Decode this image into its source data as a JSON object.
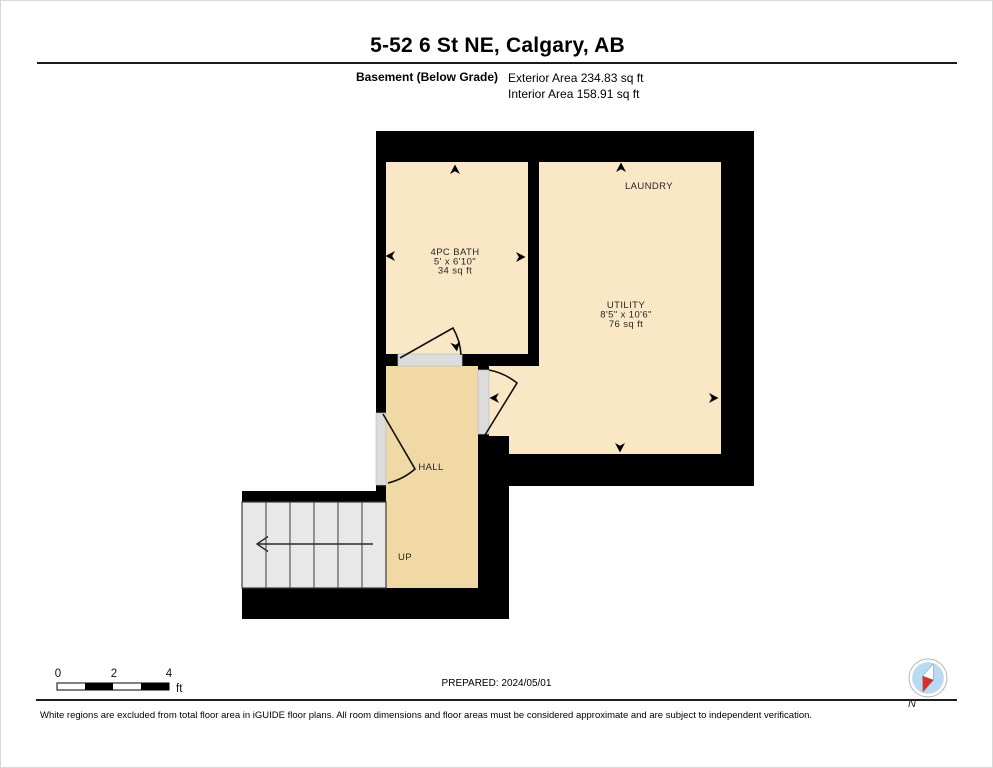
{
  "header": {
    "title": "5-52 6 St NE, Calgary, AB",
    "floor_label": "Basement (Below Grade)",
    "exterior_area": "Exterior Area 234.83 sq ft",
    "interior_area": "Interior Area 158.91 sq ft"
  },
  "floorplan": {
    "rooms": {
      "bath": {
        "name": "4PC BATH",
        "dims": "5' x 6'10\"",
        "area": "34 sq ft"
      },
      "laundry": {
        "name": "LAUNDRY"
      },
      "utility": {
        "name": "UTILITY",
        "dims": "8'5\" x 10'6\"",
        "area": "76 sq ft"
      },
      "hall": {
        "name": "HALL"
      }
    },
    "stairs": {
      "direction_label": "UP"
    },
    "colors": {
      "wall": "#000000",
      "room_fill": "#FAE7C5",
      "hall_fill": "#F0D9A4",
      "door_opening": "#DCDCDC",
      "stairs_fill": "#E8E8E8"
    }
  },
  "scale_bar": {
    "tick0": "0",
    "tick1": "2",
    "tick2": "4",
    "unit": "ft"
  },
  "prepared_label": "PREPARED: 2024/05/01",
  "compass": {
    "north_label": "N",
    "circle_color": "#B7DBF4",
    "needle_red": "#DD2C2C"
  },
  "footer_disclaimer": "White regions are excluded from total floor area in iGUIDE floor plans. All room dimensions and floor areas must be considered approximate and are subject to independent verification."
}
